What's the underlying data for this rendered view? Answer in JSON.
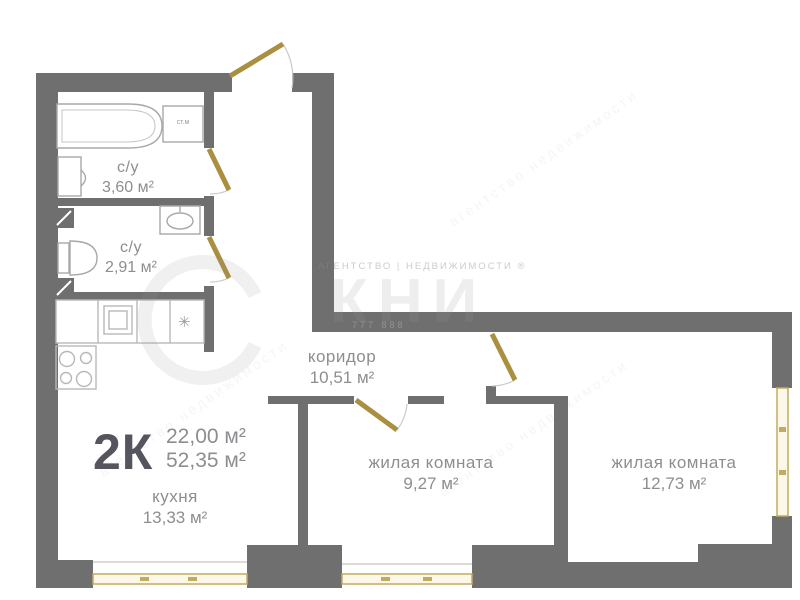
{
  "plan_summary": {
    "type_label": "2К",
    "living_area": "22,00 м²",
    "total_area": "52,35 м²"
  },
  "rooms": [
    {
      "name": "с/у",
      "area": "3,60 м²"
    },
    {
      "name": "с/у",
      "area": "2,91 м²"
    },
    {
      "name": "коридор",
      "area": "10,51 м²"
    },
    {
      "name": "кухня",
      "area": "13,33 м²"
    },
    {
      "name": "жилая комната",
      "area": "9,27 м²"
    },
    {
      "name": "жилая комната",
      "area": "12,73 м²"
    }
  ],
  "fixtures": {
    "washer_label": "ст.м",
    "snowflake_icon": "✳"
  },
  "watermark": {
    "agency_word1": "АГЕНТСТВО",
    "divider": "|",
    "agency_word2": "НЕДВИЖИМОСТИ ®",
    "logo_letters": "КНИ",
    "phone": "777 888",
    "diag_text": "агентство недвижимости"
  },
  "colors": {
    "wall": "#6f6f6f",
    "door": "#a98f3f",
    "window_frame": "#c2aa60",
    "window_fill": "#fcf8e8",
    "label_text": "#8e8e92",
    "type_text": "#55555e",
    "fixture_line": "#a3a3a3"
  }
}
